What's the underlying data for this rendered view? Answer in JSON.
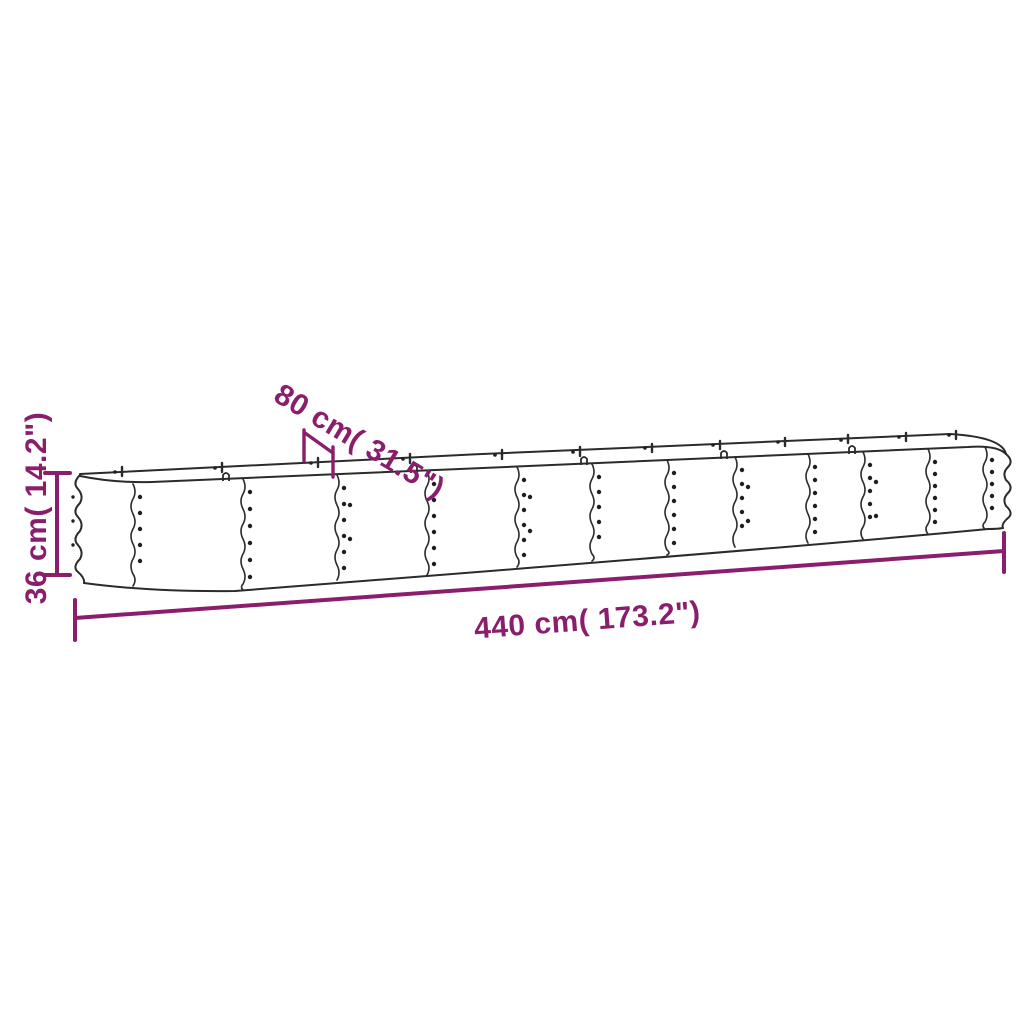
{
  "page": {
    "background": "#ffffff",
    "kind": "product-dimension-diagram",
    "subject": "oval galvanized-steel raised garden bed, corrugated panels with rivets, shown in perspective"
  },
  "colors": {
    "line_art": "#2b2b2b",
    "dimension_accent": "#8a1e6c"
  },
  "dimensions": {
    "length": {
      "label": "440 cm( 173.2\")",
      "cm": 440,
      "inches": 173.2
    },
    "width": {
      "label": "80 cm( 31.5\")",
      "cm": 80,
      "inches": 31.5
    },
    "height": {
      "label": "36 cm( 14.2\")",
      "cm": 36,
      "inches": 14.2
    }
  },
  "drawing": {
    "panel_seam_count": 12,
    "ends": "corrugated rounded ends",
    "details": "rim segment ticks, small clips on top edge, rivet dot columns along each seam"
  }
}
